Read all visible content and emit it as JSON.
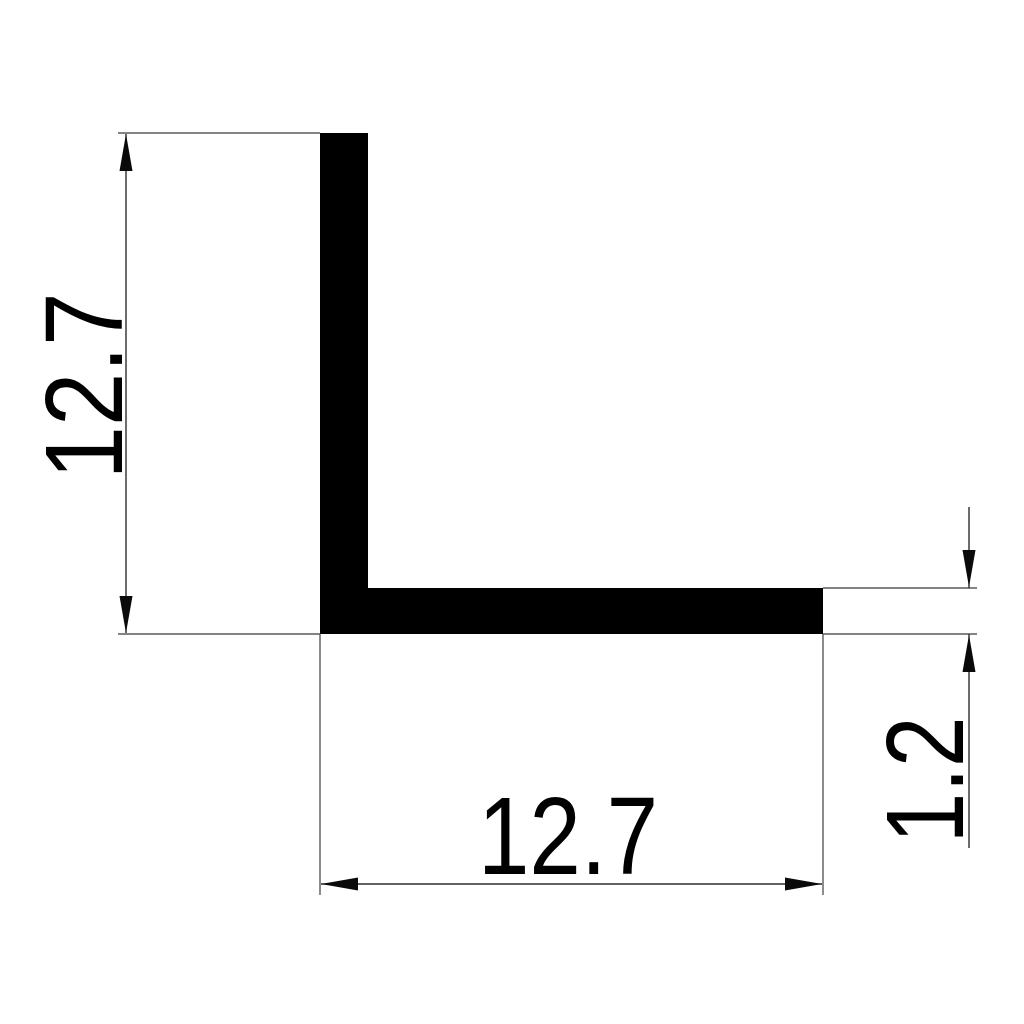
{
  "drawing": {
    "shape": "l-angle-profile-cross-section",
    "background_color": "#ffffff",
    "profile_color": "#000000",
    "extension_line_color": "#5a5a5a",
    "dimension_line_color": "#2e2e2e",
    "text_color": "#000000"
  },
  "dimensions": {
    "height": {
      "value": "12.7",
      "position": "left",
      "orientation": "vertical"
    },
    "width": {
      "value": "12.7",
      "position": "bottom",
      "orientation": "horizontal"
    },
    "thickness": {
      "value": "1.2",
      "position": "right",
      "orientation": "vertical"
    }
  }
}
